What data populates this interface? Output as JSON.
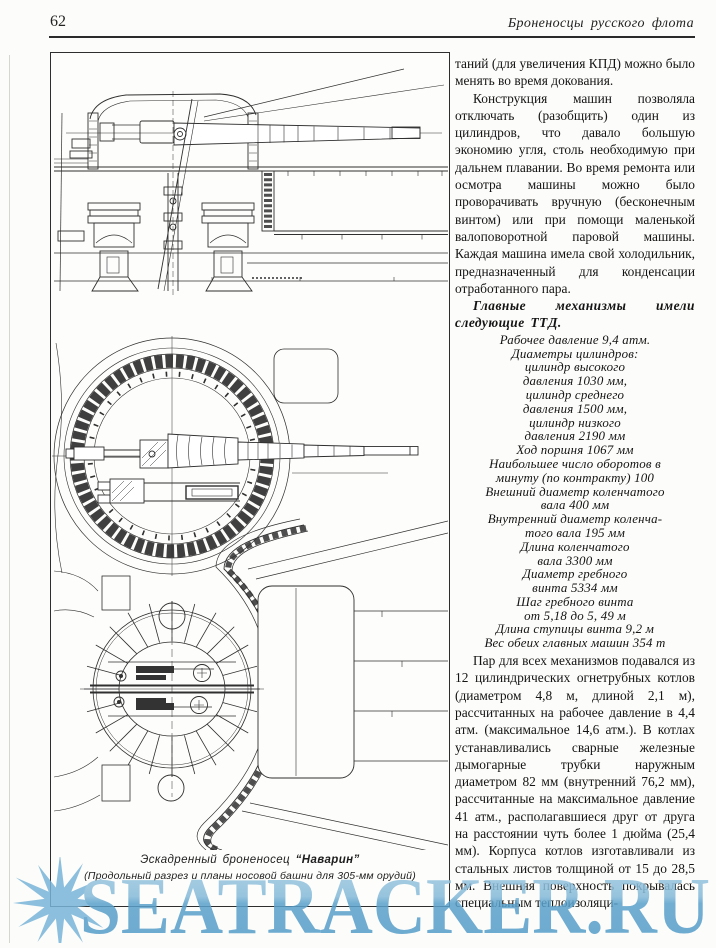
{
  "page": {
    "number": "62",
    "header_title": "Броненосцы русского флота"
  },
  "article": {
    "p1": "таний (для увеличения КПД) можно было менять  во время докования.",
    "p2": "Конструкция машин позволяла отключать (разобщить) один из цилиндров, что давало большую экономию угля, столь необходимую при дальнем плавании. Во время  ремонта или осмотра машины можно было проворачивать вручную (бесконечным винтом) или при помощи маленькой валоповоротной паровой машины. Каждая машина имела свой холодильник, предназначенный для конденсации отработанного пара.",
    "heading": "Главные механизмы имели следующие ТТД.",
    "specs": [
      "Рабочее давление 9,4 атм.",
      "Диаметры цилиндров:",
      "цилиндр высокого",
      "давления  1030 мм,",
      "цилиндр среднего",
      "давления  1500 мм,",
      "цилиндр низкого",
      "давления  2190 мм",
      "Ход поршня  1067 мм",
      "Наибольшее число оборотов в",
      "минуту  (по контракту) 100",
      "Внешний диаметр коленчатого",
      "вала 400 мм",
      "Внутренний диаметр коленча-",
      "того вала 195 мм",
      "Длина коленчатого",
      "вала 3300 мм",
      "Диаметр гребного",
      "винта 5334 мм",
      "Шаг гребного винта",
      "от 5,18 до 5, 49 м",
      "Длина ступицы винта 9,2 м",
      "Вес обеих главных машин 354 т"
    ],
    "p3": "Пар для всех механизмов подавался из 12 цилиндрических огнетрубных котлов (диаметром 4,8 м, длиной 2,1 м), рассчитанных на рабочее давление в 4,4 атм. (максимальное 14,6 атм.). В котлах устанавливались сварные железные дымогарные трубки наружным диаметром 82 мм (внутренний 76,2 мм), рассчитанные на максимальное давление 41 атм., располагавшиеся друг от друга на расстоянии чуть более 1 дюйма (25,4 мм). Корпуса котлов изготавливали из стальных листов толщиной от 15 до 28,5 мм. Внешняя поверхность покрывалась специальным теплоизоляци-"
  },
  "figure": {
    "caption_prefix": "Эскадренный броненосец ",
    "caption_ship": "“Наварин”",
    "caption_line2": "(Продольный разрез и планы носовой башни для  305-мм орудий)"
  },
  "watermark": {
    "text": "SEATRACKER.RU",
    "color_light": "#9cc8e1",
    "color_dark": "#5aa1cb"
  }
}
